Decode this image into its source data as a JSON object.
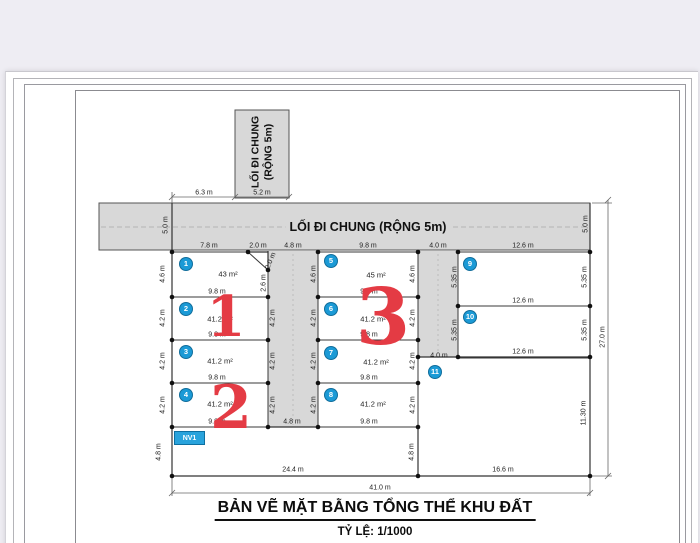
{
  "header": {
    "title": "BẢN VẼ MẶT BẰNG TỔNG THỂ KHU ĐẤT",
    "scale_note": "TỶ LỆ: 1/1000"
  },
  "roads": {
    "vertical_label": "LỐI ĐI CHUNG (RỘNG 5m)",
    "horizontal_label": "LỐI ĐI CHUNG (RỘNG 5m)"
  },
  "annotations": {
    "nv1": "NV1"
  },
  "colors": {
    "road_fill": "#d8d8d8",
    "badge_blue": "#1b9ad6",
    "red_number": "#e43b44",
    "nv1_blue": "#29a3dc"
  },
  "zone_numbers": [
    {
      "text": "1",
      "x": 226,
      "y": 317,
      "size": 56
    },
    {
      "text": "2",
      "x": 231,
      "y": 408,
      "size": 60
    },
    {
      "text": "3",
      "x": 383,
      "y": 318,
      "size": 78
    }
  ],
  "plot_badges": [
    {
      "n": "1",
      "x": 186,
      "y": 264
    },
    {
      "n": "2",
      "x": 186,
      "y": 309
    },
    {
      "n": "3",
      "x": 186,
      "y": 352
    },
    {
      "n": "4",
      "x": 186,
      "y": 395
    },
    {
      "n": "5",
      "x": 331,
      "y": 261
    },
    {
      "n": "6",
      "x": 331,
      "y": 309
    },
    {
      "n": "7",
      "x": 331,
      "y": 353
    },
    {
      "n": "8",
      "x": 331,
      "y": 395
    },
    {
      "n": "9",
      "x": 470,
      "y": 264
    },
    {
      "n": "10",
      "x": 470,
      "y": 317
    },
    {
      "n": "11",
      "x": 435,
      "y": 372
    }
  ],
  "area_labels": [
    {
      "text": "43 m²",
      "x": 228,
      "y": 274
    },
    {
      "text": "45 m²",
      "x": 376,
      "y": 275
    },
    {
      "text": "41.2 m²",
      "x": 220,
      "y": 319
    },
    {
      "text": "41.2 m²",
      "x": 220,
      "y": 361
    },
    {
      "text": "41.2 m²",
      "x": 220,
      "y": 404
    },
    {
      "text": "41.2 m²",
      "x": 373,
      "y": 319
    },
    {
      "text": "41.2 m²",
      "x": 376,
      "y": 362
    },
    {
      "text": "41.2 m²",
      "x": 373,
      "y": 404
    }
  ],
  "dim_labels": [
    {
      "text": "6.3 m",
      "x": 204,
      "y": 193,
      "rot": 0
    },
    {
      "text": "5.2 m",
      "x": 262,
      "y": 193,
      "rot": 0
    },
    {
      "text": "5.0 m",
      "x": 166,
      "y": 225,
      "rot": -90
    },
    {
      "text": "5.0 m",
      "x": 586,
      "y": 224,
      "rot": -90
    },
    {
      "text": "7.8 m",
      "x": 209,
      "y": 246,
      "rot": 0
    },
    {
      "text": "2.0 m",
      "x": 258,
      "y": 246,
      "rot": 0
    },
    {
      "text": "4.8 m",
      "x": 293,
      "y": 246,
      "rot": 0
    },
    {
      "text": "9.8 m",
      "x": 368,
      "y": 246,
      "rot": 0
    },
    {
      "text": "4.0 m",
      "x": 438,
      "y": 246,
      "rot": 0
    },
    {
      "text": "12.6 m",
      "x": 523,
      "y": 246,
      "rot": 0
    },
    {
      "text": "2.0 m",
      "x": 271,
      "y": 261,
      "rot": -68
    },
    {
      "text": "2.6 m",
      "x": 264,
      "y": 283,
      "rot": -90
    },
    {
      "text": "4.6 m",
      "x": 163,
      "y": 274,
      "rot": -90
    },
    {
      "text": "4.2 m",
      "x": 163,
      "y": 318,
      "rot": -90
    },
    {
      "text": "4.2 m",
      "x": 163,
      "y": 361,
      "rot": -90
    },
    {
      "text": "4.2 m",
      "x": 163,
      "y": 405,
      "rot": -90
    },
    {
      "text": "4.8 m",
      "x": 159,
      "y": 452,
      "rot": -90
    },
    {
      "text": "4.2 m",
      "x": 273,
      "y": 318,
      "rot": -90
    },
    {
      "text": "4.2 m",
      "x": 273,
      "y": 361,
      "rot": -90
    },
    {
      "text": "4.2 m",
      "x": 273,
      "y": 405,
      "rot": -90
    },
    {
      "text": "9.8 m",
      "x": 217,
      "y": 292,
      "rot": 0
    },
    {
      "text": "9.8 m",
      "x": 217,
      "y": 335,
      "rot": 0
    },
    {
      "text": "9.8 m",
      "x": 217,
      "y": 378,
      "rot": 0
    },
    {
      "text": "9.8 m",
      "x": 217,
      "y": 422,
      "rot": 0
    },
    {
      "text": "4.6 m",
      "x": 314,
      "y": 274,
      "rot": -90
    },
    {
      "text": "4.6 m",
      "x": 413,
      "y": 274,
      "rot": -90
    },
    {
      "text": "4.2 m",
      "x": 314,
      "y": 318,
      "rot": -90
    },
    {
      "text": "4.2 m",
      "x": 314,
      "y": 361,
      "rot": -90
    },
    {
      "text": "4.2 m",
      "x": 314,
      "y": 405,
      "rot": -90
    },
    {
      "text": "4.2 m",
      "x": 413,
      "y": 318,
      "rot": -90
    },
    {
      "text": "4.2 m",
      "x": 413,
      "y": 361,
      "rot": -90
    },
    {
      "text": "4.2 m",
      "x": 413,
      "y": 405,
      "rot": -90
    },
    {
      "text": "9.8 m",
      "x": 369,
      "y": 292,
      "rot": 0
    },
    {
      "text": "9.8 m",
      "x": 369,
      "y": 335,
      "rot": 0
    },
    {
      "text": "9.8 m",
      "x": 369,
      "y": 378,
      "rot": 0
    },
    {
      "text": "9.8 m",
      "x": 369,
      "y": 422,
      "rot": 0
    },
    {
      "text": "4.8 m",
      "x": 292,
      "y": 422,
      "rot": 0
    },
    {
      "text": "4.0 m",
      "x": 439,
      "y": 356,
      "rot": 0
    },
    {
      "text": "4.8 m",
      "x": 412,
      "y": 452,
      "rot": -90
    },
    {
      "text": "12.6 m",
      "x": 523,
      "y": 301,
      "rot": 0
    },
    {
      "text": "12.6 m",
      "x": 523,
      "y": 352,
      "rot": 0
    },
    {
      "text": "5.35 m",
      "x": 455,
      "y": 277,
      "rot": -90
    },
    {
      "text": "5.35 m",
      "x": 455,
      "y": 330,
      "rot": -90
    },
    {
      "text": "5.35 m",
      "x": 585,
      "y": 277,
      "rot": -90
    },
    {
      "text": "5.35 m",
      "x": 585,
      "y": 330,
      "rot": -90
    },
    {
      "text": "11.30 m",
      "x": 584,
      "y": 413,
      "rot": -90
    },
    {
      "text": "27.0 m",
      "x": 603,
      "y": 337,
      "rot": -90
    },
    {
      "text": "24.4 m",
      "x": 293,
      "y": 470,
      "rot": 0
    },
    {
      "text": "16.6 m",
      "x": 503,
      "y": 470,
      "rot": 0
    },
    {
      "text": "41.0 m",
      "x": 380,
      "y": 488,
      "rot": 0
    }
  ]
}
